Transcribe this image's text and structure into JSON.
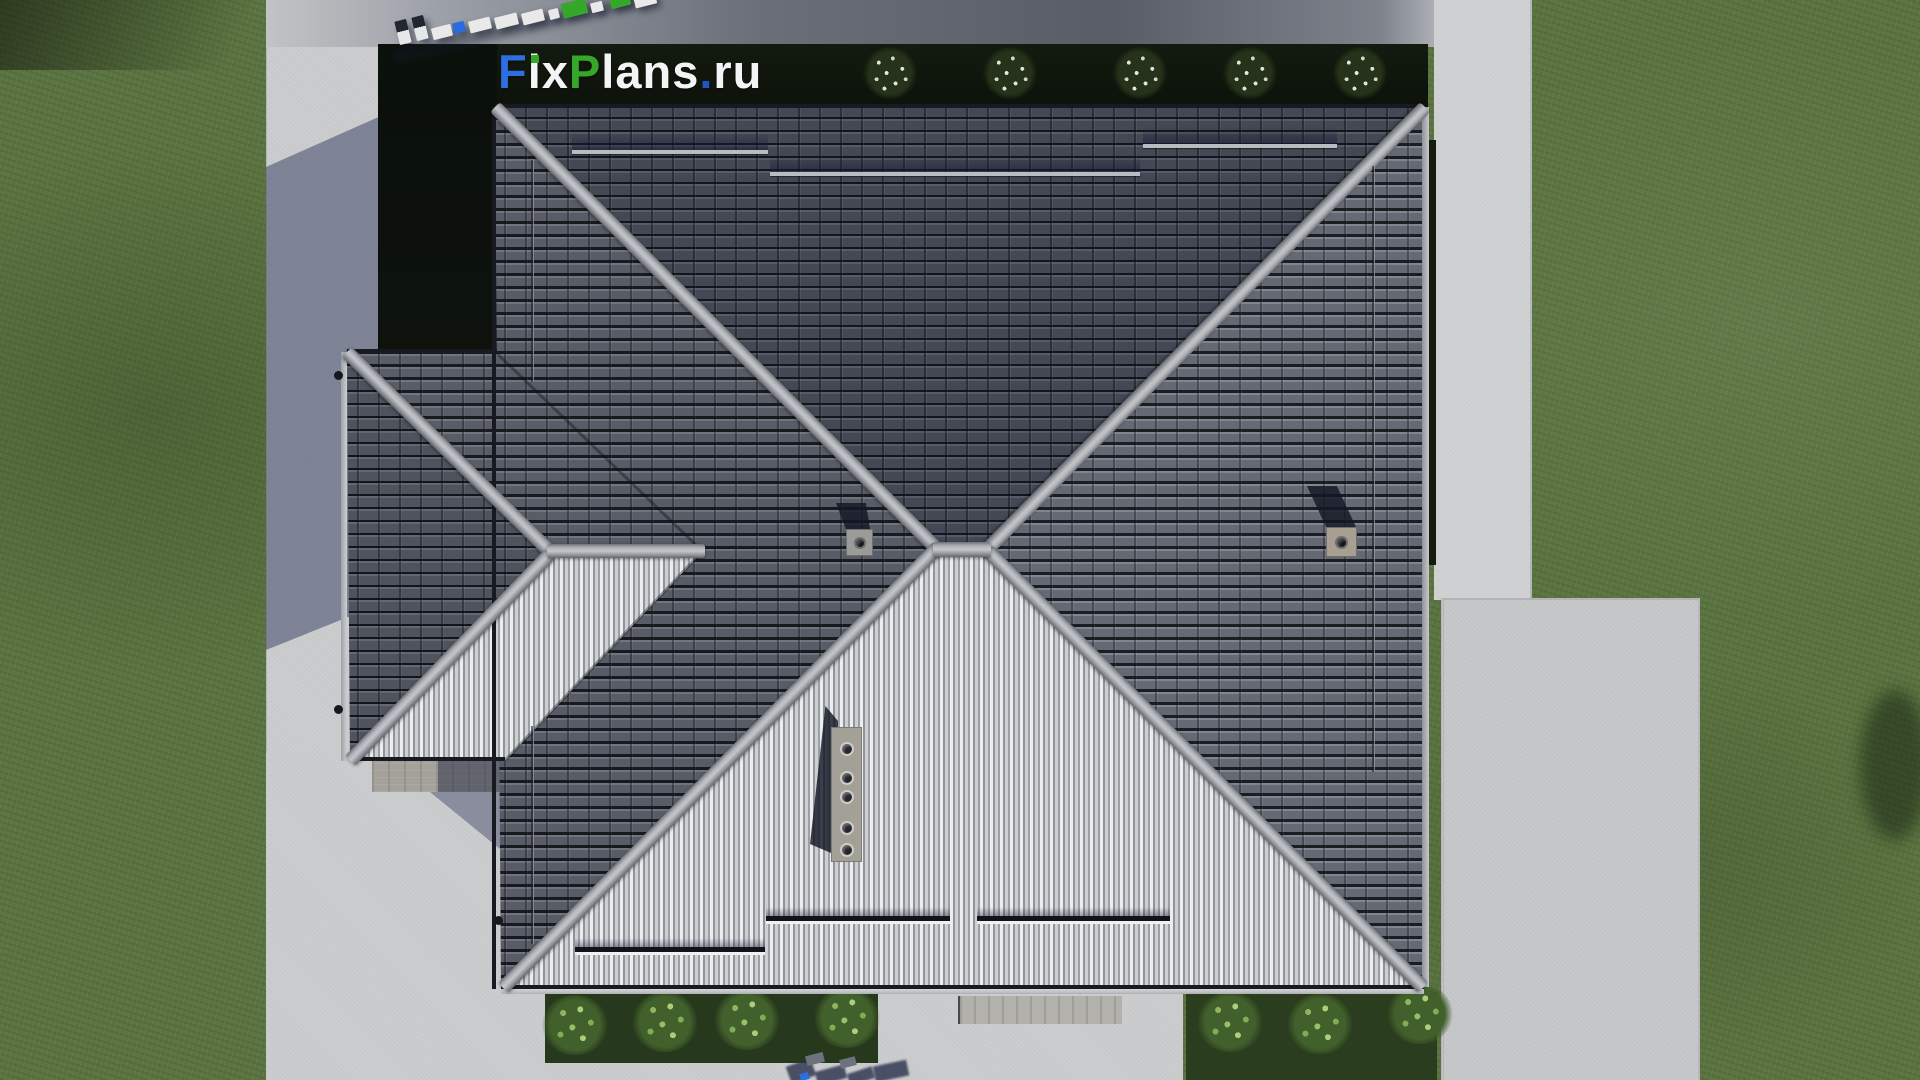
{
  "logo": {
    "text": "FixPlans.ru",
    "segments": [
      {
        "t": "F",
        "c": "#2e6de2"
      },
      {
        "t": "i",
        "c": "#f3f4f5",
        "dot": "#36a829"
      },
      {
        "t": "x",
        "c": "#f3f4f5"
      },
      {
        "t": "P",
        "c": "#36a829"
      },
      {
        "t": "lans",
        "c": "#f3f4f5"
      },
      {
        "t": ".",
        "c": "#2453c4"
      },
      {
        "t": "ru",
        "c": "#f3f4f5"
      }
    ]
  },
  "colors": {
    "grass": "#5b7441",
    "concrete_light": "#cbccce",
    "roof_north": "#434854",
    "roof_east": "#646974",
    "roof_west": "#575c67",
    "roof_south": "#b4b6b9",
    "ridge": "#b0b3b7",
    "hedge": "#10170d",
    "logo_blue": "#2e6de2",
    "logo_green": "#36a829",
    "logo_white": "#f3f4f5"
  },
  "scene": {
    "watermark_blocks": [
      [
        397,
        20,
        12,
        24,
        "d"
      ],
      [
        414,
        16,
        12,
        24,
        "d"
      ],
      [
        432,
        26,
        20,
        12,
        "w"
      ],
      [
        453,
        22,
        12,
        11,
        "b"
      ],
      [
        469,
        19,
        22,
        12,
        "w"
      ],
      [
        495,
        15,
        23,
        12,
        "w"
      ],
      [
        522,
        11,
        22,
        12,
        "w"
      ],
      [
        549,
        9,
        10,
        10,
        "w"
      ],
      [
        562,
        1,
        25,
        15,
        "g"
      ],
      [
        591,
        2,
        12,
        10,
        "w"
      ],
      [
        610,
        -6,
        20,
        13,
        "g"
      ],
      [
        634,
        -7,
        22,
        13,
        "w"
      ]
    ],
    "top_bushes": [
      890,
      1010,
      1140,
      1250,
      1360
    ],
    "left_bushes": [
      [
        575,
        1025
      ],
      [
        665,
        1022
      ],
      [
        747,
        1020
      ],
      [
        847,
        1018
      ]
    ],
    "right_bushes": [
      [
        1230,
        1022
      ],
      [
        1320,
        1024
      ],
      [
        1420,
        1014
      ]
    ],
    "north_guards": [
      [
        572,
        150,
        196
      ],
      [
        770,
        172,
        370
      ],
      [
        1143,
        144,
        194
      ]
    ],
    "south_guards": [
      [
        575,
        947,
        190
      ],
      [
        766,
        916,
        184
      ],
      [
        977,
        916,
        193
      ]
    ],
    "seams": [
      [
        531,
        160,
        222
      ],
      [
        531,
        726,
        218
      ],
      [
        1372,
        166,
        606
      ]
    ],
    "gutter_dots": [
      [
        334,
        371
      ],
      [
        334,
        705
      ],
      [
        494,
        916
      ]
    ],
    "chimney_center": {
      "x": 846,
      "y": 529,
      "w": 27,
      "h": 27
    },
    "chimney_right": {
      "x": 1326,
      "y": 527,
      "w": 31,
      "h": 30
    },
    "vent_strip": {
      "x": 831,
      "y": 727,
      "w": 31,
      "h": 135
    },
    "vent_holes": [
      741,
      770,
      789,
      820,
      842
    ],
    "bottom_shadow_blocks": [
      [
        788,
        1062,
        26,
        18,
        -20
      ],
      [
        816,
        1068,
        30,
        14,
        -15
      ],
      [
        848,
        1070,
        26,
        12,
        -18
      ],
      [
        874,
        1063,
        34,
        16,
        -12
      ]
    ],
    "bottom_gray_blocks": [
      [
        806,
        1054,
        18,
        10
      ],
      [
        840,
        1058,
        16,
        9
      ]
    ],
    "bottom_blue_block": [
      800,
      1073,
      9,
      7
    ]
  }
}
